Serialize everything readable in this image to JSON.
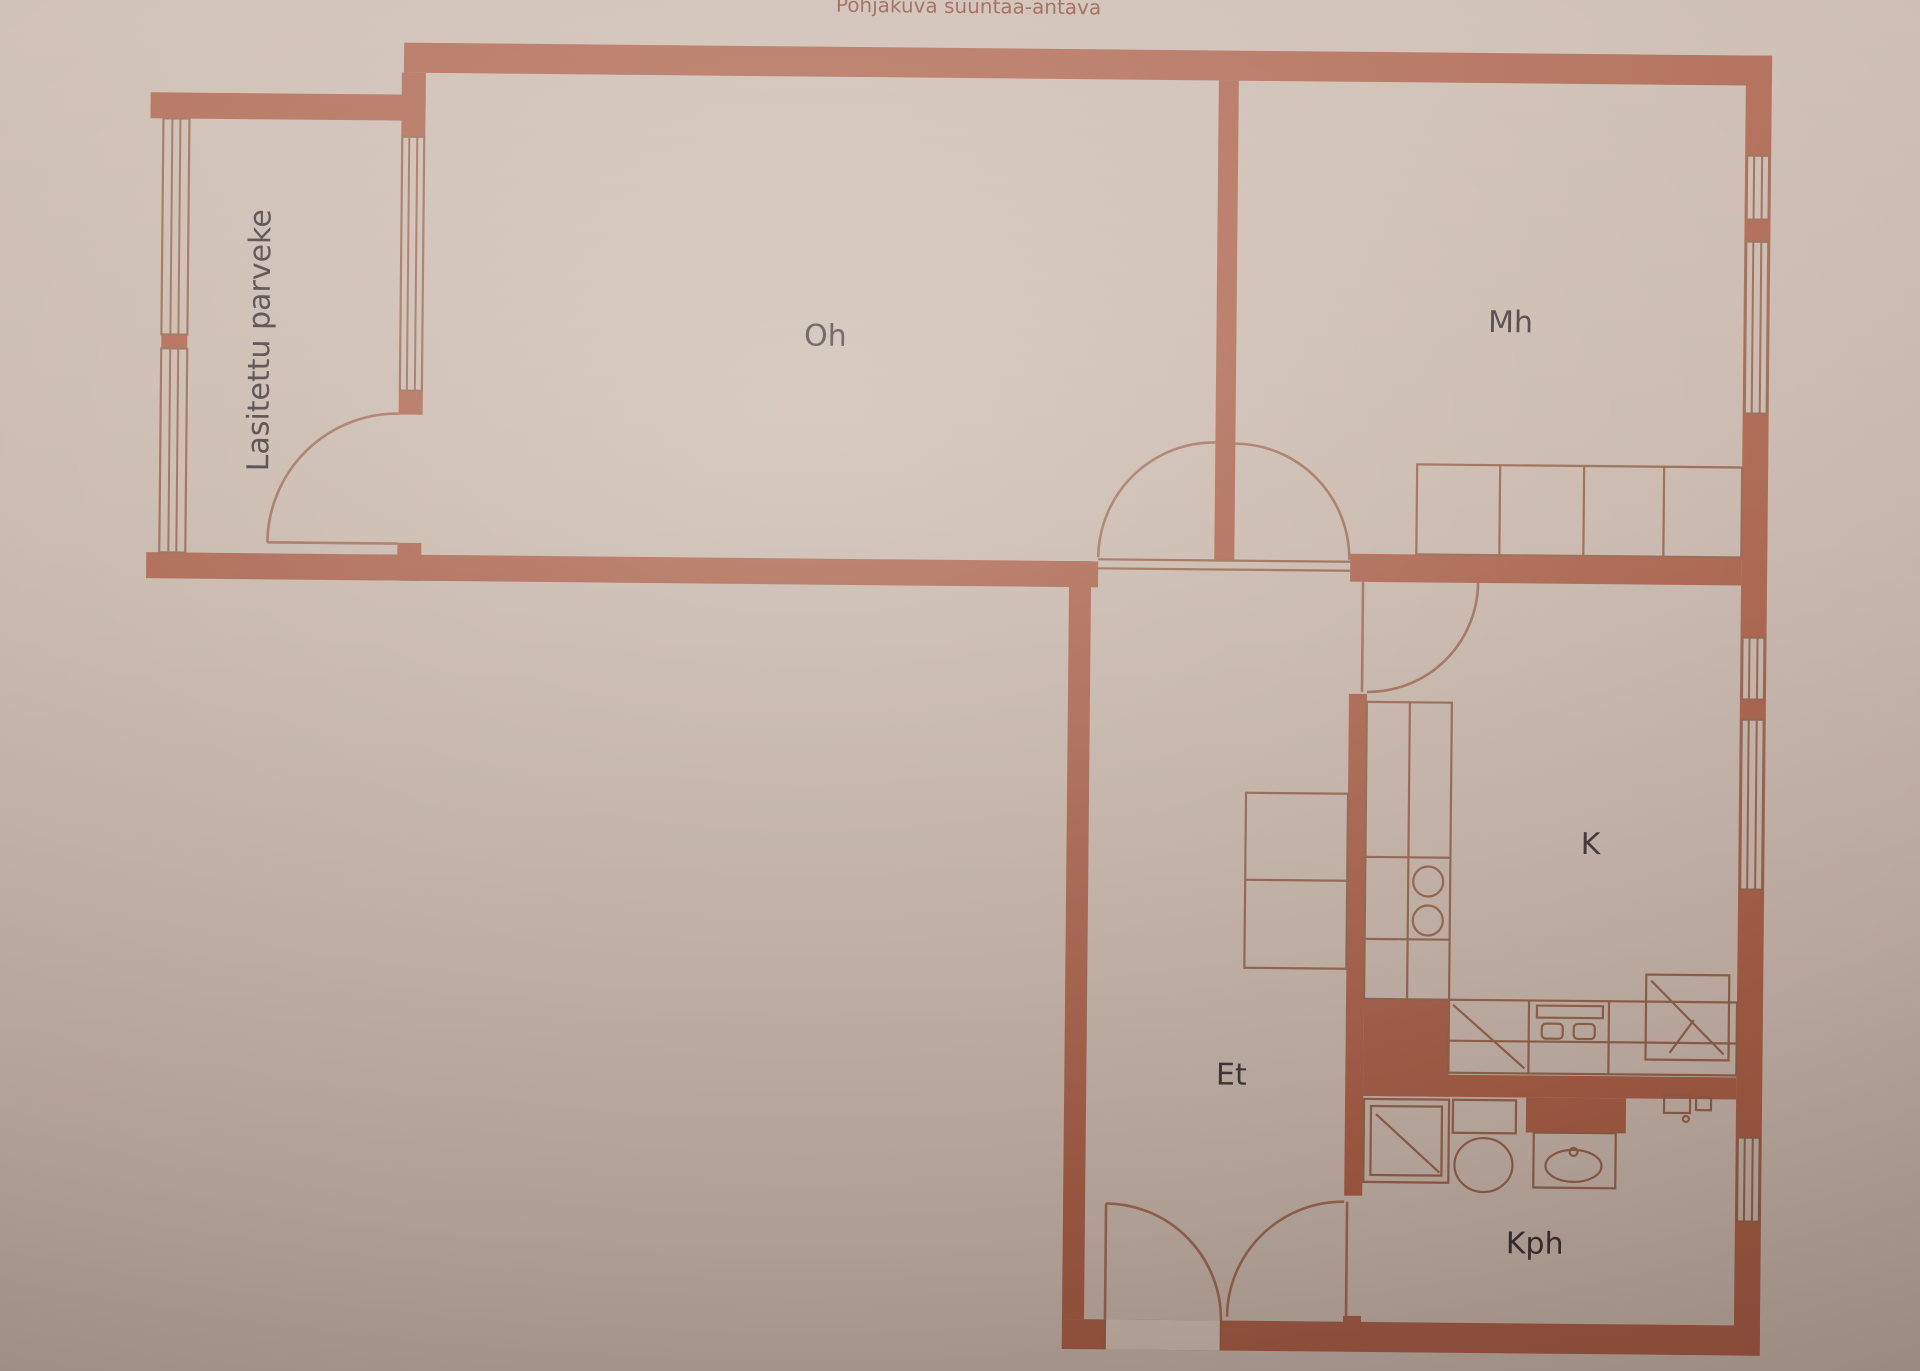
{
  "title": "Pohjakuva suuntaa-antava",
  "rooms": {
    "balcony": {
      "label": "Lasitettu parveke"
    },
    "living": {
      "label": "Oh"
    },
    "bedroom": {
      "label": "Mh"
    },
    "kitchen": {
      "label": "K"
    },
    "hall": {
      "label": "Et"
    },
    "bathroom": {
      "label": "Kph"
    }
  },
  "colors": {
    "paper": "#c9b7ac",
    "paperLight": "#d3c2b7",
    "wall": "#aa5f48",
    "line": "#95634b",
    "arc": "#9e6c55",
    "text": "#3a3134",
    "title": "#8d4b39"
  }
}
